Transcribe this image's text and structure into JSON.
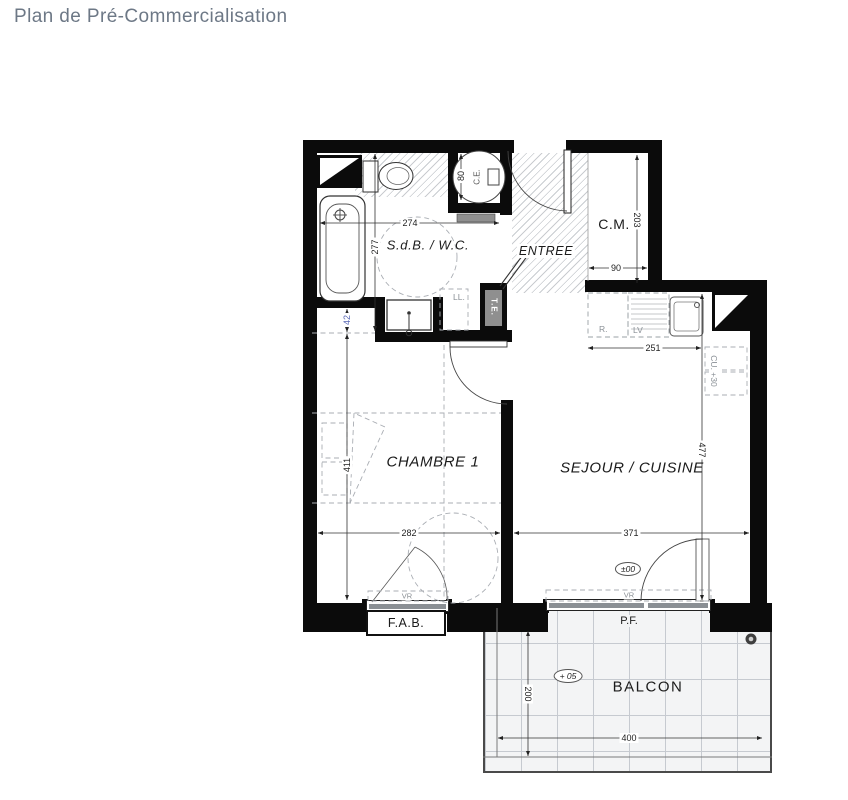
{
  "page": {
    "title": "Plan de Pré-Commercialisation"
  },
  "rooms": {
    "sdb": "S.d.B. / W.C.",
    "entree": "ENTREE",
    "cm": "C.M.",
    "chambre": "CHAMBRE 1",
    "sejour": "SEJOUR / CUISINE",
    "balcon": "BALCON"
  },
  "labels": {
    "fab": "F.A.B.",
    "pf": "P.F.",
    "te": "T.E.",
    "ll": "LL.",
    "vr": "VR",
    "cu": "CU. +30",
    "fridge": "R.",
    "dishwasher": "LV",
    "heater": "C.E.",
    "level_interior": "±00",
    "level_balcony": "+ 05"
  },
  "dimensions": {
    "sdb_width": "274",
    "sdb_depth": "277",
    "cm_depth": "203",
    "cm_width": "90",
    "wall_offset": "42",
    "chambre_depth": "411",
    "chambre_width": "282",
    "kitchen_width": "251",
    "sejour_depth": "477",
    "sejour_width": "371",
    "balcon_depth": "200",
    "balcon_width": "400",
    "heater_diameter": "80"
  },
  "colors": {
    "wall": "#0b0b0b",
    "title": "#6d7886",
    "annotation_blue": "#5a68b5",
    "hatch": "#c9ccd0"
  }
}
